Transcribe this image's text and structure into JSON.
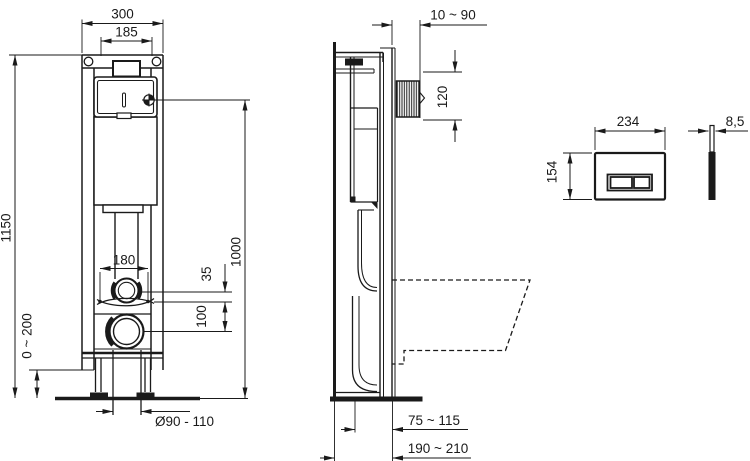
{
  "drawing": {
    "title": "concealed-cistern-frame-installation-drawing",
    "line_color": "#1a1a1a",
    "background": "#ffffff",
    "front_view": {
      "overall_width": "300",
      "tank_width": "185",
      "frame_height": "1150",
      "inlet_height": "1000",
      "fixing_width": "180",
      "offset_top": "35",
      "offset_bottom": "100",
      "leg_adjust": "0 ~ 200",
      "outlet_diameter": "Ø90 - 110"
    },
    "side_view": {
      "wall_distance": "10 ~ 90",
      "cutout_height": "120",
      "bowl_offset": "75 ~ 115",
      "depth_range": "190 ~ 210"
    },
    "flush_plate": {
      "width": "234",
      "height": "154",
      "thickness": "8,5"
    }
  }
}
